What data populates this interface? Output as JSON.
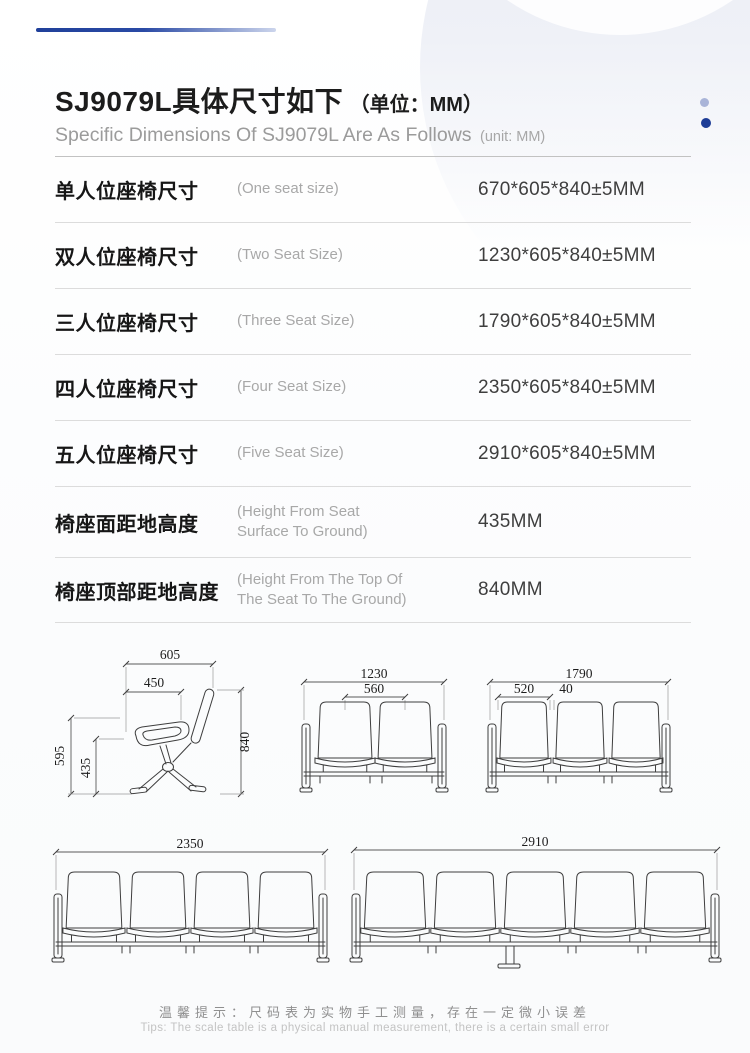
{
  "header": {
    "title_zh": "SJ9079L具体尺寸如下",
    "title_unit": "（单位：MM）",
    "subtitle_en": "Specific Dimensions Of SJ9079L Are As Follows",
    "subtitle_unit": "(unit: MM)"
  },
  "colors": {
    "accent_blue": "#1d3c96",
    "accent_blue_light": "#a9b4d8",
    "bar_gradient_start": "#20409a",
    "bar_gradient_end": "#ccd5ec"
  },
  "table": {
    "rows": [
      {
        "label_zh": "单人位座椅尺寸",
        "label_en": "(One seat size)",
        "value": "670*605*840±5MM"
      },
      {
        "label_zh": "双人位座椅尺寸",
        "label_en": "(Two Seat Size)",
        "value": "1230*605*840±5MM"
      },
      {
        "label_zh": "三人位座椅尺寸",
        "label_en": "(Three Seat Size)",
        "value": "1790*605*840±5MM"
      },
      {
        "label_zh": "四人位座椅尺寸",
        "label_en": "(Four Seat Size)",
        "value": "2350*605*840±5MM"
      },
      {
        "label_zh": "五人位座椅尺寸",
        "label_en": "(Five Seat Size)",
        "value": "2910*605*840±5MM"
      },
      {
        "label_zh": "椅座面距地高度",
        "label_en": "(Height From Seat\nSurface To Ground)",
        "value": "435MM"
      },
      {
        "label_zh": "椅座顶部距地高度",
        "label_en": "(Height From The Top Of\n The Seat To The Ground)",
        "value": "840MM"
      }
    ]
  },
  "drawings": {
    "single": {
      "top_width": "605",
      "seat_depth": "450",
      "total_height": "840",
      "back_height": "595",
      "seat_height": "435"
    },
    "two_seat": {
      "total_width": "1230",
      "seat_pitch": "560"
    },
    "three_seat": {
      "total_width": "1790",
      "seat_width": "520",
      "gap": "40"
    },
    "four_seat": {
      "total_width": "2350"
    },
    "five_seat": {
      "total_width": "2910"
    }
  },
  "footer": {
    "tip_zh": "温馨提示：尺码表为实物手工测量，存在一定微小误差",
    "tip_en": "Tips: The scale table is a physical manual measurement, there is a certain small error"
  }
}
